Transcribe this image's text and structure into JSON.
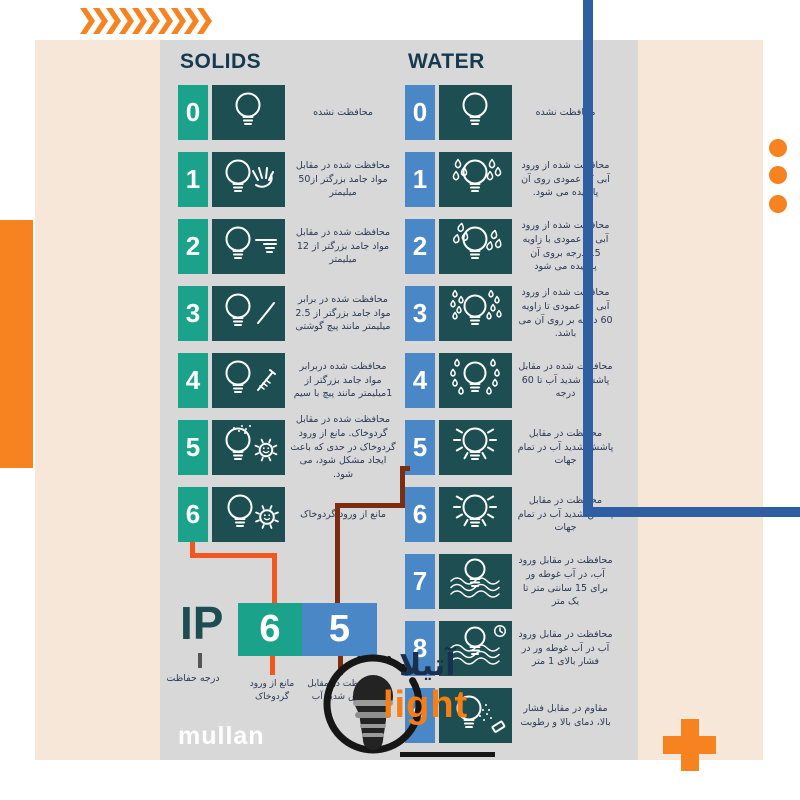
{
  "header": {
    "solids": "SOLIDS",
    "water": "WATER"
  },
  "solids": {
    "rows": [
      {
        "num": "0",
        "icon": "bulb",
        "text": "محافظت نشده"
      },
      {
        "num": "1",
        "icon": "bulb-hand",
        "text": "محافظت شده در مقابل مواد جامد بزرگتر از50 میلیمتر"
      },
      {
        "num": "2",
        "icon": "bulb-finger",
        "text": "محافظت شده در مقابل مواد جامد بزرگتر از 12 میلیمتر"
      },
      {
        "num": "3",
        "icon": "bulb-screwdriver",
        "text": "محافظت شده در برابر مواد جامد بزرگتر از 2.5 میلیمتر مانند پیچ گوشتی"
      },
      {
        "num": "4",
        "icon": "bulb-screw",
        "text": "محافظت شده دربرابر مواد جامد بزرگتر از 1میلیمتر مانند پیچ با سیم"
      },
      {
        "num": "5",
        "icon": "bulb-dust",
        "text": "محافظت شده در مقابل گردوخاک. مانع از ورود گردوخاک در حدی که باعث ایجاد مشکل شود، می شود."
      },
      {
        "num": "6",
        "icon": "bulb-gear",
        "text": "مانع از ورود گردوخاک"
      }
    ]
  },
  "water": {
    "rows": [
      {
        "num": "0",
        "icon": "bulb",
        "text": "محافظت نشده"
      },
      {
        "num": "1",
        "icon": "bulb-drops",
        "text": "محافظت شده از ورود آبی که عمودی روی آن پاشیده می شود."
      },
      {
        "num": "2",
        "icon": "bulb-drops-tilt",
        "text": "محافظت شده از ورود آبی به عمودی با زاویه 15 درجه بروی آن پاشیده می شود"
      },
      {
        "num": "3",
        "icon": "bulb-spray",
        "text": "محافظت شده از ورود آبی که عمودی تا زاویه 60 درجه بر روی آن می باشد."
      },
      {
        "num": "4",
        "icon": "bulb-splash",
        "text": "محافظت شده در مقابل پاشش شدید آب تا 60 درجه"
      },
      {
        "num": "5",
        "icon": "bulb-jet",
        "text": "محافظت در مقابل پاشش شدید آب در تمام جهات"
      },
      {
        "num": "6",
        "icon": "bulb-jet",
        "text": "محافظت در مقابل پاشش شدید آب در تمام جهات"
      },
      {
        "num": "7",
        "icon": "bulb-immersion",
        "text": "محافظت در مقابل ورود آب، در آب غوطه ور برای 15 سانتی متر تا یک متر"
      },
      {
        "num": "8",
        "icon": "bulb-immersion-clock",
        "text": "محافظت در مقابل ورود آب در آب غوطه ور در فشار بالای 1 متر"
      },
      {
        "num": "9",
        "icon": "bulb-pressure",
        "text": "مقاوم در مقابل فشار بالا، دمای بالا و رطوبت"
      }
    ]
  },
  "ip_section": {
    "label": "IP",
    "digit_solid": "6",
    "digit_water": "5",
    "ip_caption": "درجه حفاظت",
    "solid_caption": "مانع از ورود گردوخاک",
    "water_caption": "محافظت در مقابل پاشش شدید آب"
  },
  "branding": {
    "maker": "mullan",
    "logo_fa": "آتیلا",
    "logo_en": "light"
  },
  "colors": {
    "accent_orange": "#F6831F",
    "connector_orange": "#F1571E",
    "connector_maroon": "#7C2D0F",
    "blue_line": "#2E5FA3",
    "solids_tile": "#1AA38A",
    "water_tile": "#4A87C6",
    "icon_tile": "#1C4E52",
    "panel_gray": "#D8D8D8",
    "panel_peach": "#F6E7D8"
  }
}
